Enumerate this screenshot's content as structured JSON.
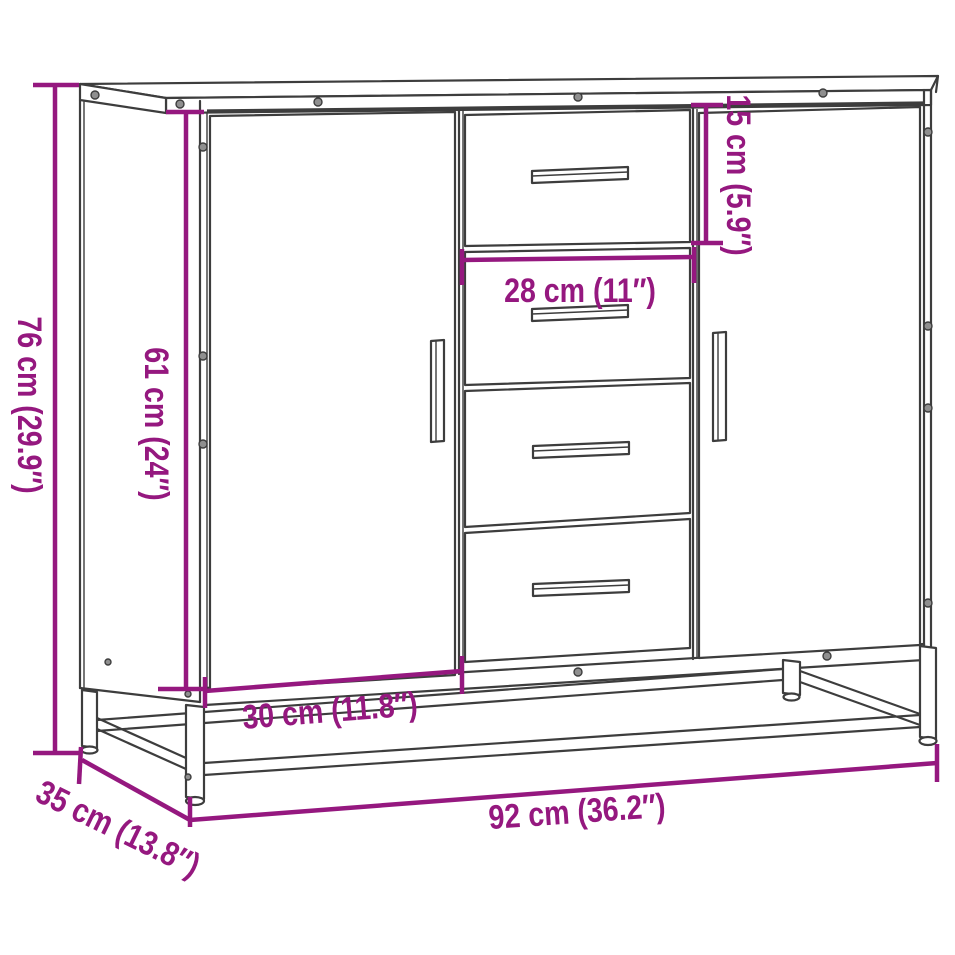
{
  "colors": {
    "dimension": "#95187F",
    "edges": "#3D3D3D",
    "background": "#FFFFFF"
  },
  "diagram": {
    "type": "furniture-dimension-diagram",
    "subject": "sideboard with two doors, four middle drawers and metal base frame",
    "dimensions": [
      {
        "id": "total-height",
        "label": "76 cm (29.9″)",
        "value_cm": 76,
        "value_in": 29.9,
        "orientation": "vertical"
      },
      {
        "id": "body-height",
        "label": "61 cm (24″)",
        "value_cm": 61,
        "value_in": 24,
        "orientation": "vertical"
      },
      {
        "id": "top-drawer-height",
        "label": "15 cm (5.9″)",
        "value_cm": 15,
        "value_in": 5.9,
        "orientation": "vertical"
      },
      {
        "id": "drawer-width",
        "label": "28 cm (11″)",
        "value_cm": 28,
        "value_in": 11,
        "orientation": "horizontal"
      },
      {
        "id": "door-section-width",
        "label": "30 cm (11.8″)",
        "value_cm": 30,
        "value_in": 11.8,
        "orientation": "horizontal"
      },
      {
        "id": "total-depth",
        "label": "35 cm (13.8″)",
        "value_cm": 35,
        "value_in": 13.8,
        "orientation": "diagonal"
      },
      {
        "id": "total-width",
        "label": "92 cm (36.2″)",
        "value_cm": 92,
        "value_in": 36.2,
        "orientation": "horizontal"
      }
    ]
  }
}
